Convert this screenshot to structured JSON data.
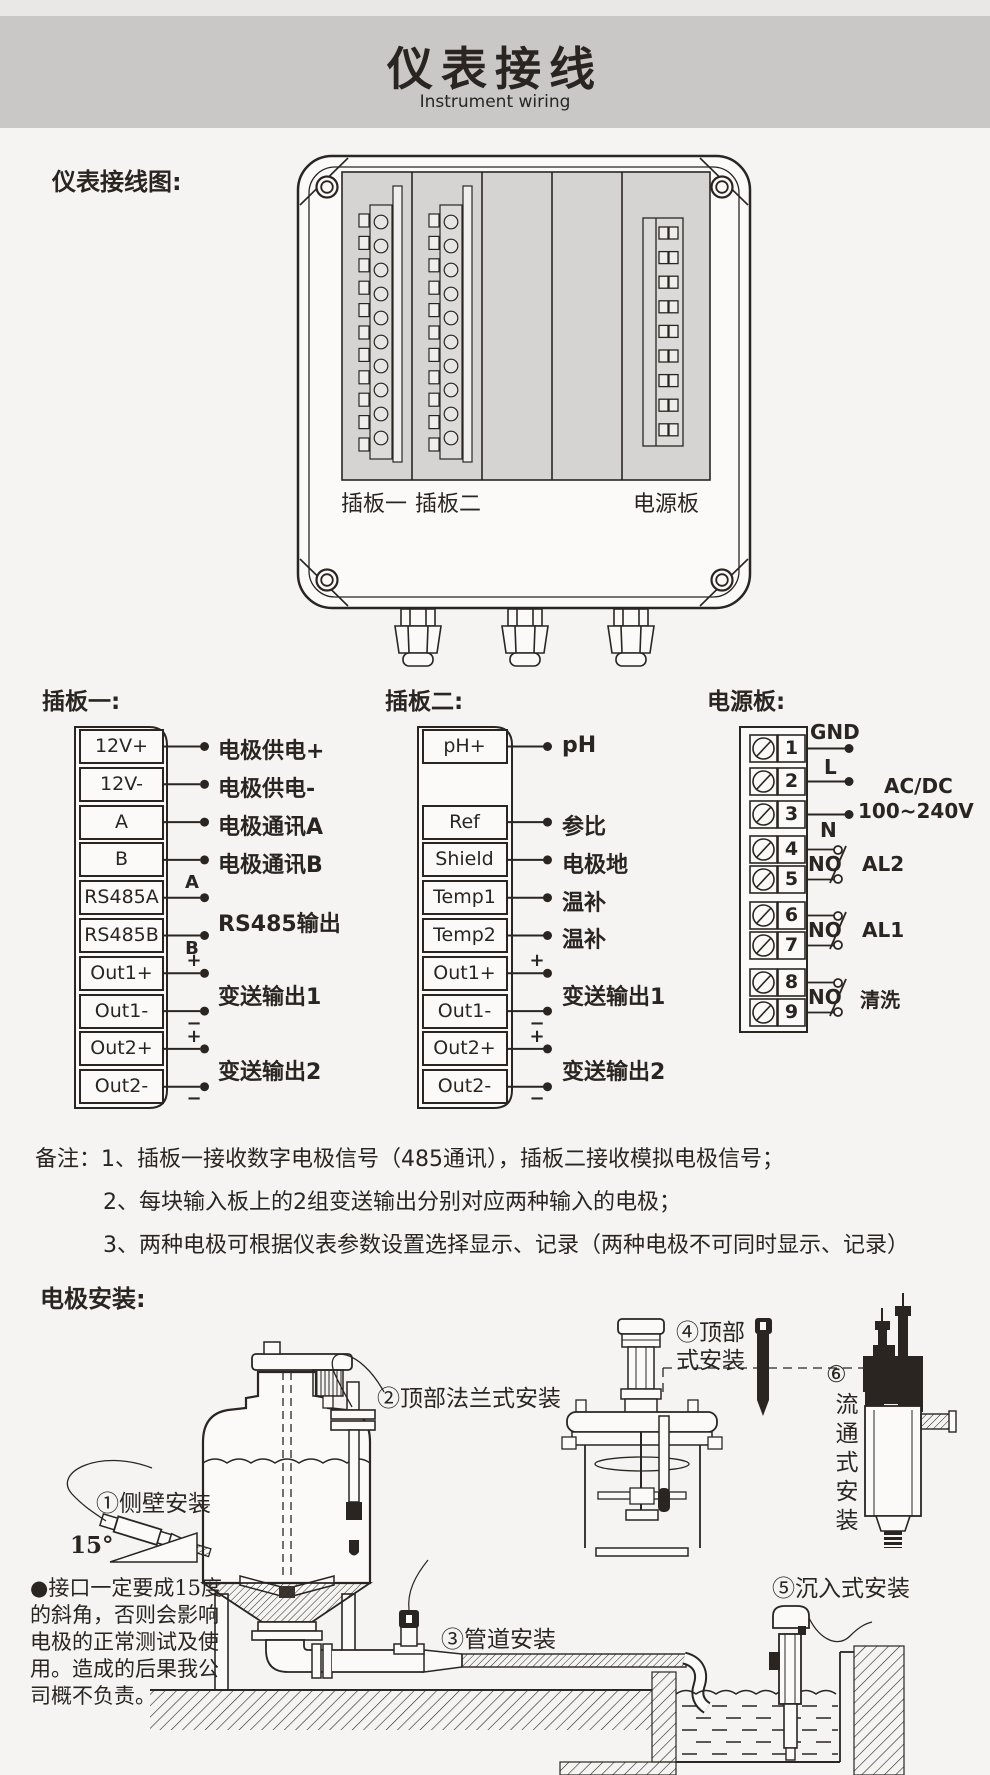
{
  "colors": {
    "ink": "#2b2521",
    "panel": "#d6d4d2",
    "band": "#cac8c7",
    "page": "#f5f4f2"
  },
  "header": {
    "title": "仪表接线",
    "subtitle": "Instrument wiring"
  },
  "wiring": {
    "section_label": "仪表接线图:",
    "panel_labels": {
      "board1": "插板一",
      "board2": "插板二",
      "power": "电源板"
    }
  },
  "board1": {
    "title": "插板一:",
    "terminals": [
      {
        "name": "12V+",
        "label": "电极供电+"
      },
      {
        "name": "12V-",
        "label": "电极供电-"
      },
      {
        "name": "A",
        "label": "电极通讯A"
      },
      {
        "name": "B",
        "label": "电极通讯B"
      },
      {
        "name": "RS485A",
        "mark": "A"
      },
      {
        "name": "RS485B",
        "mark": "B"
      },
      {
        "name": "Out1+",
        "mark": "+"
      },
      {
        "name": "Out1-",
        "mark": "−"
      },
      {
        "name": "Out2+",
        "mark": "+"
      },
      {
        "name": "Out2-",
        "mark": "−"
      }
    ],
    "groups": {
      "rs485": "RS485输出",
      "out1": "变送输出1",
      "out2": "变送输出2"
    }
  },
  "board2": {
    "title": "插板二:",
    "terminals": [
      {
        "name": "pH+",
        "label": "pH"
      },
      {
        "name": "Ref",
        "label": "参比"
      },
      {
        "name": "Shield",
        "label": "电极地"
      },
      {
        "name": "Temp1",
        "label": "温补"
      },
      {
        "name": "Temp2",
        "label": "温补"
      },
      {
        "name": "Out1+",
        "mark": "+"
      },
      {
        "name": "Out1-",
        "mark": "−"
      },
      {
        "name": "Out2+",
        "mark": "+"
      },
      {
        "name": "Out2-",
        "mark": "−"
      }
    ],
    "groups": {
      "out1": "变送输出1",
      "out2": "变送输出2"
    }
  },
  "power": {
    "title": "电源板:",
    "numbers": [
      "1",
      "2",
      "3",
      "4",
      "5",
      "6",
      "7",
      "8",
      "9"
    ],
    "gnd": "GND",
    "l": "L",
    "n": "N",
    "ac": "AC/DC",
    "voltage": "100~240V",
    "relays": [
      {
        "no": "NO",
        "label": "AL2"
      },
      {
        "no": "NO",
        "label": "AL1"
      },
      {
        "no": "NO",
        "label": "清洗"
      }
    ]
  },
  "notes": {
    "line1": "备注：1、插板一接收数字电极信号（485通讯），插板二接收模拟电极信号；",
    "line2": "2、每块输入板上的2组变送输出分别对应两种输入的电极；",
    "line3": "3、两种电极可根据仪表参数设置选择显示、记录（两种电极不可同时显示、记录）"
  },
  "install": {
    "title": "电极安装:",
    "angle": "15°",
    "methods": {
      "side": "①侧壁安装",
      "top_flange": "②顶部法兰式安装",
      "pipe": "③管道安装",
      "top_line1": "④顶部",
      "top_line2": "式安装",
      "immersion": "⑤沉入式安装",
      "flow_num": "⑥",
      "flow_text": "流通式安装"
    },
    "warning": {
      "line1": "●接口一定要成15度",
      "line2": "的斜角，否则会影响",
      "line3": "电极的正常测试及使",
      "line4": "用。造成的后果我公",
      "line5": "司概不负责。"
    }
  }
}
